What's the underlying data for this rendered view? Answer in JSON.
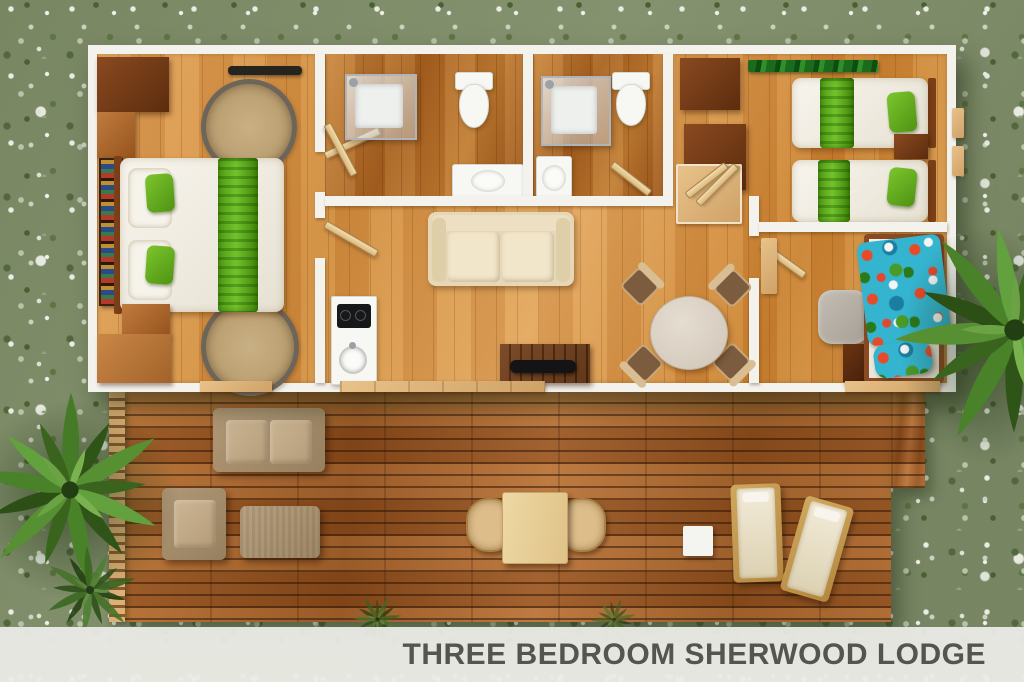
{
  "caption": {
    "title": "THREE BEDROOM SHERWOOD LODGE"
  },
  "palette": {
    "grass_base": "#85926f",
    "wall": "#f4f2ed",
    "indoor_floor": "#d4913f",
    "bathroom_floor": "#a5601f",
    "deck_floor": "#9a5a24",
    "bedding_green": "#5fae1a",
    "tropical_teal": "#35b4cf",
    "outdoor_furniture": "#b19877",
    "caption_bar": "#ebece7",
    "caption_text": "#54554e"
  },
  "scene": {
    "label": "three-bedroom-lodge-floor-plan-top-view",
    "rooms": [
      {
        "name": "master-bedroom",
        "furniture": [
          "double-bed",
          "wardrobe",
          "bookshelf",
          "round-rug",
          "round-rug",
          "bedside-bench",
          "ac-unit"
        ]
      },
      {
        "name": "bathroom-1",
        "furniture": [
          "shower",
          "toilet",
          "washbasin",
          "door"
        ]
      },
      {
        "name": "bathroom-2",
        "furniture": [
          "shower",
          "toilet",
          "washbasin",
          "door"
        ]
      },
      {
        "name": "twin-bedroom",
        "furniture": [
          "single-bed",
          "single-bed",
          "nightstand",
          "wardrobe",
          "wardrobe",
          "green-runner-rug",
          "desk"
        ]
      },
      {
        "name": "third-bedroom",
        "furniture": [
          "single-bed-tropical",
          "nightstand",
          "floor-cushion",
          "desk",
          "door"
        ]
      },
      {
        "name": "living-area",
        "furniture": [
          "sofa",
          "tv-stand",
          "tv",
          "round-dining-table",
          "dining-chair",
          "dining-chair",
          "dining-chair",
          "dining-chair",
          "kitchenette-counter",
          "cooktop",
          "kitchen-sink"
        ]
      },
      {
        "name": "deck",
        "furniture": [
          "outdoor-sofa",
          "outdoor-armchair",
          "outdoor-coffee-table",
          "picnic-table",
          "bench",
          "bench",
          "side-table",
          "sun-lounger",
          "sun-lounger"
        ]
      }
    ],
    "vegetation": [
      "fan-palm-left",
      "fan-palm-right",
      "fern-cluster",
      "grass-tufts"
    ]
  }
}
